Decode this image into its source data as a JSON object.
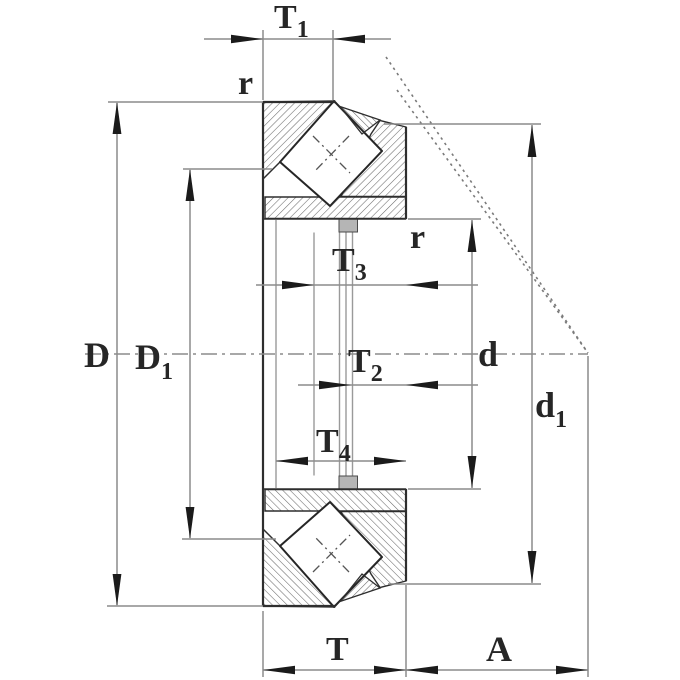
{
  "figure": {
    "title": "Axial spherical roller bearing cross-section drawing",
    "background": "#ffffff",
    "colors": {
      "part_line": "#2e2e2e",
      "dimension_line": "#8c8c8c",
      "arrowhead": "#1b1b1b",
      "hatch": "#6b6b6b",
      "label_text": "#262626",
      "bore_lip_fill": "#b5b5b5"
    },
    "labels": {
      "T1": {
        "main": "T",
        "sub": "1"
      },
      "r_top": {
        "main": "r"
      },
      "D": {
        "main": "D"
      },
      "D1": {
        "main": "D",
        "sub": "1"
      },
      "T3": {
        "main": "T",
        "sub": "3"
      },
      "r_right": {
        "main": "r"
      },
      "T2": {
        "main": "T",
        "sub": "2"
      },
      "d": {
        "main": "d"
      },
      "d1": {
        "main": "d",
        "sub": "1"
      },
      "T4": {
        "main": "T",
        "sub": "4"
      },
      "T": {
        "main": "T"
      },
      "A": {
        "main": "A"
      }
    }
  }
}
